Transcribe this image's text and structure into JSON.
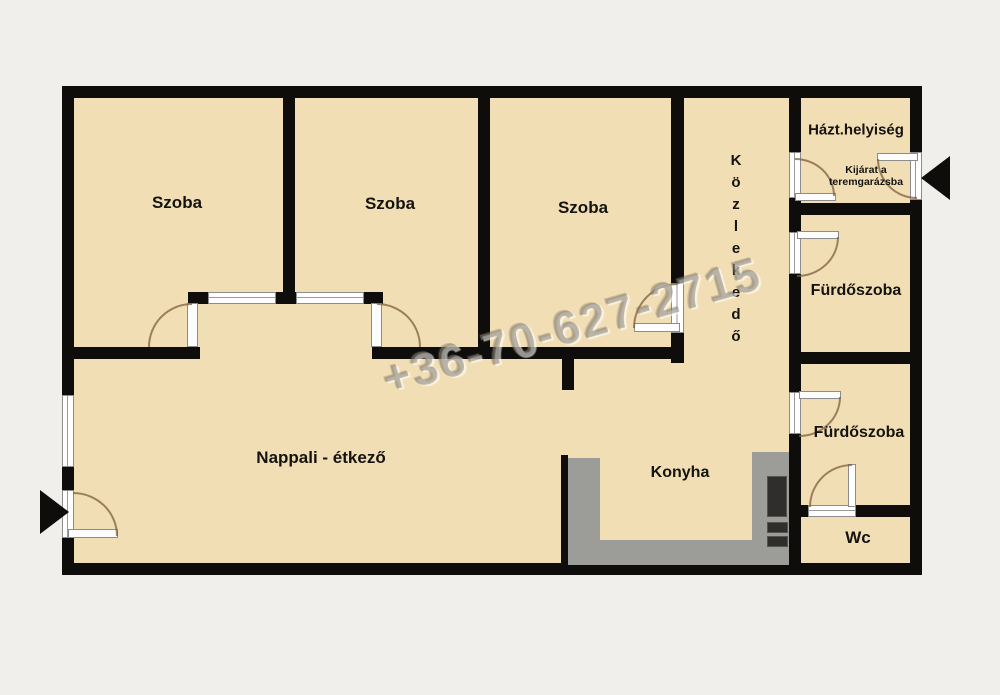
{
  "plan": {
    "rooms": {
      "szoba1": {
        "label": "Szoba"
      },
      "szoba2": {
        "label": "Szoba"
      },
      "szoba3": {
        "label": "Szoba"
      },
      "kozlekedo": {
        "label": "Közlekedő"
      },
      "haztartasi": {
        "label": "Házt.helyiség"
      },
      "kijarat": {
        "line1": "Kijárat a",
        "line2": "teremgarázsba"
      },
      "furdoszoba1": {
        "label": "Fürdőszoba"
      },
      "furdoszoba2": {
        "label": "Fürdőszoba"
      },
      "wc": {
        "label": "Wc"
      },
      "nappali": {
        "label": "Nappali - étkező"
      },
      "konyha": {
        "label": "Konyha"
      }
    },
    "watermark": {
      "text": "+36-70-627-2715"
    },
    "colors": {
      "background": "#f1efec",
      "room_fill": "#f2deb4",
      "wall": "#0e0d0b",
      "kitchen_counter": "#9c9c98",
      "watermark_gray": "#8a8478",
      "door_arc_brown": "#7d5f3c"
    }
  }
}
